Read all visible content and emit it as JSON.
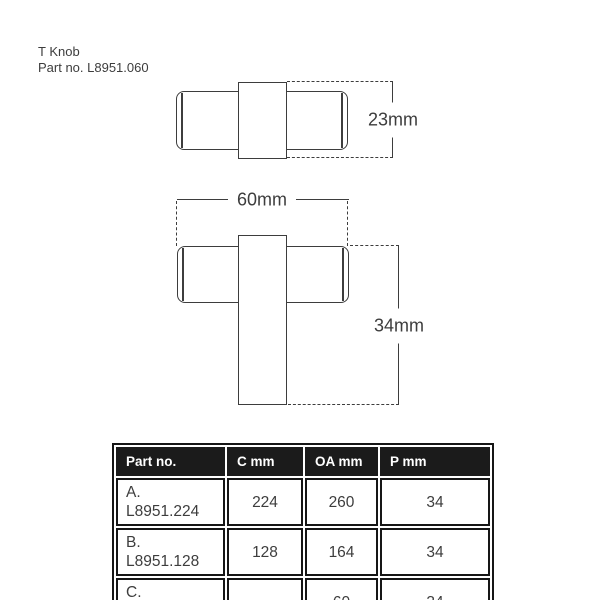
{
  "page": {
    "product_name": "T Knob",
    "part_number_line": "Part no. L8951.060"
  },
  "diagrams": {
    "top_view": {
      "height_label": "23mm"
    },
    "front_view": {
      "width_label": "60mm",
      "projection_label": "34mm"
    }
  },
  "spec_table": {
    "headers": [
      "Part no.",
      "C mm",
      "OA mm",
      "P mm"
    ],
    "rows": [
      {
        "part_no": "A. L8951.224",
        "c_mm": "224",
        "oa_mm": "260",
        "p_mm": "34"
      },
      {
        "part_no": "B. L8951.128",
        "c_mm": "128",
        "oa_mm": "164",
        "p_mm": "34"
      },
      {
        "part_no": "C. L8951.060",
        "c_mm": "-",
        "oa_mm": "60",
        "p_mm": "34"
      }
    ]
  },
  "colors": {
    "background": "#ffffff",
    "line": "#3d3d3d",
    "text": "#3d3d3d",
    "table_header_bg": "#1b1b1b",
    "table_header_text": "#ffffff",
    "table_border": "#161616"
  }
}
